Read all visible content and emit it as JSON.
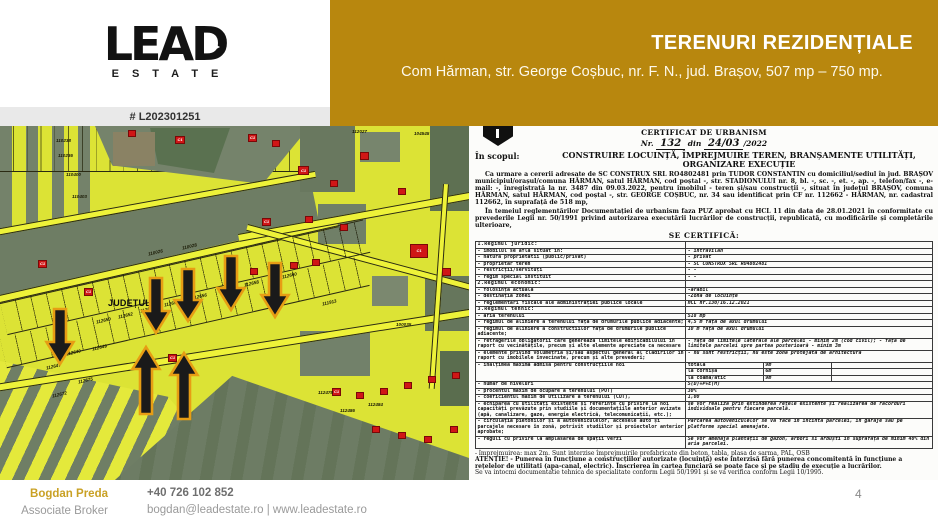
{
  "colors": {
    "band_gold": "#b8870e",
    "brand_gold": "#c9a125",
    "marker_red": "#d01616",
    "arrow_black": "#1a1a1a",
    "arrow_outline": "#e79d14",
    "map_yellow": "#dce335"
  },
  "header": {
    "brand": "LEAD",
    "brand_sub": "ESTATE",
    "ref": "# L202301251",
    "title": "TERENURI REZIDENȚIALE",
    "subtitle": "Com Hărman,  str. George Coșbuc,  nr. F. N.,  jud.  Brașov, 507 mp – 750 mp."
  },
  "map": {
    "region_label": "JUDEȚUL B",
    "building_marker_label": "C1",
    "parcel_labels": [
      "110238",
      "110236",
      "110400",
      "110403",
      "112027",
      "104545",
      "110026",
      "110028",
      "111913",
      "100035",
      "112650",
      "112652",
      "112653",
      "112654",
      "112656",
      "112657",
      "112658",
      "112660",
      "112640",
      "112647",
      "112649",
      "112675",
      "112672",
      "112478",
      "112484",
      "112486"
    ]
  },
  "document": {
    "title": "CERTIFICAT DE URBANISM",
    "nr_prefix": "Nr.",
    "nr_value": "132",
    "din": "din",
    "date_value": "24/03",
    "year": "/2022",
    "scop_label": "În scopul:",
    "scop_line1": "CONSTRUIRE LOCUINȚĂ, ÎMPREJMUIRE TEREN, BRANȘAMENTE UTILITĂȚI,",
    "scop_line2": "ORGANIZARE EXECUȚIE",
    "para1": "Ca urmare a cererii adresate de SC CONSTRUX SRL RO4802481 prin TUDOR CONSTANTIN cu domiciliul/sediul în jud. BRAȘOV municipiul/orașul/comuna HĂRMAN, satul HĂRMAN, cod poștal -, str. STADIONULUI nr. 8, bl. -, sc. -, et. -, ap. -, telefon/fax -, e-mail: -, înregistrată la nr. 3487 din 09.03.2022, pentru imobilul - teren și/sau construcții -, situat în județul BRAȘOV, comuna HĂRMAN, satul HĂRMAN, cod poștal -, str. GEORGE COȘBUC, nr. 34 sau identificat prin CF nr. 112662 - HĂRMAN, nr. cadastral 112662, în suprafață de 518 mp,",
    "para2": "În temeiul reglementărilor Documentației de urbanism faza PUZ aprobat cu HCL 11 din data de 28.01.2021 în conformitate cu prevederile Legii nr. 50/1991 privind autorizarea executării lucrărilor de construcții, republicată, cu modificările și completările ulterioare,",
    "certify": "SE CERTIFICĂ:",
    "table": [
      {
        "type": "sec",
        "l": "1.Regimul juridic:",
        "r": ""
      },
      {
        "l": "- imobilul se află situat în:",
        "r": "- intravilan"
      },
      {
        "l": "- natura proprietatii (public/privat)",
        "r": "- privat"
      },
      {
        "l": "- proprietar teren",
        "r": "- SC CONSTRUX SRL RO4802481"
      },
      {
        "l": "- restricții/servituți",
        "r": "- -"
      },
      {
        "l": "- regim special instituit",
        "r": "- -"
      },
      {
        "type": "sec",
        "l": "2.Regimul economic:",
        "r": ""
      },
      {
        "l": "- folosința actuală",
        "r": "-arabil"
      },
      {
        "l": "- destinația zonei",
        "r": "-Zonă de locuințe"
      },
      {
        "l": "- reglementări fiscale ale administrației publice locale",
        "r": "HCL nr.130/16.12.2021"
      },
      {
        "type": "sec",
        "l": "3.Regimul tehnic:",
        "r": ""
      },
      {
        "l": "- aria terenului",
        "r": "518 mp"
      },
      {
        "l": "- regimul de aliniere a terenului față de drumurile publice adiacente;",
        "r": "4,5 m față de axul drumului"
      },
      {
        "l": "- regimul de aliniere a constructiilor față de drumurile publice adiacente;",
        "r": "10 m față de axul drumului"
      },
      {
        "l": "- retragerile obligatorii care generează limitele edificabilului în raport cu vecinătățile, precum și alte elemente apreciate ca necesare",
        "r": "- față de limitele laterale ale parcelei - minim 2m (cod civil); - față de limitele parcelei spre partea posterioară - minim 3m"
      },
      {
        "l": "- elemente privind volumetria și/sau aspectul general al clădirilor în raport cu imobilele învecinate, precum și alte prevederi;",
        "r": "- nu sunt restricții, nu este zona protejată de arhitectură"
      },
      {
        "type": "multi",
        "l": "- înălțimea maximă admisă pentru construcțiile noi",
        "sub": [
          [
            "totală",
            "9m"
          ],
          [
            "la cornișă",
            "6m"
          ],
          [
            "la coamă/atic",
            "9m"
          ]
        ]
      },
      {
        "l": "- număr de niveluri",
        "r": "S(D)+P+E(M)"
      },
      {
        "l": "- procentul maxim de ocupare a terenului (POT)",
        "r": "30%"
      },
      {
        "l": "- coeficientul maxim de utilizare a terenului (CUT),",
        "r": "1,00"
      },
      {
        "l": "- echiparea cu utilități existente și referințe cu privire la noi capacități prevăzute prin studiile și documentațiile anterior avizate (apă, canalizare, gaze, energie electrică, telecomunicații, etc.);",
        "r": "se vor realiza prin extinderea rețele existente și realizarea de racorduri individuale pentru fiecare parcelă."
      },
      {
        "l": "- circulația pietonilor și a autovehiculelor, accesele auto și parcajele necesare în zonă, potrivit studiilor și proiectelor anterior aprobate;",
        "r": "Parcarea autovehiculelor se va face în incinta parcelei, în garaje sau pe platforme special amenajate."
      },
      {
        "l": "- reguli cu privire la amplasarea de spații verzi",
        "r": "Se vor amenaja plantații de gazon, arbori si arbuști în suprafață de minim 40% din aria parcelei."
      }
    ],
    "footnote1": "- împrejmuirea: max 2m. Sunt interzise împrejmuirile prefabricate din beton, tabla, plasa de sarma, PAL, OSB",
    "footnote2": "ATENȚIE! - Punerea în funcțiune a construcțiilor autorizate (locuință) este interzisă fără punerea concomitentă în funcțiune a rețelelor de utilitati (apa-canal, electric). Înscrierea în cartea funciară se poate face și pe stadiu de execuție a lucrărilor.",
    "footnote3": "Se va intocmi documentatie tehnica de specialitate conform Legii 50/1991 și se va verifica conform Legii 10/1995."
  },
  "footer": {
    "name": "Bogdan Preda",
    "role": "Associate Broker",
    "phone": "+40 726 102 852",
    "email_line": "bogdan@leadestate.ro | www.leadestate.ro",
    "page": "4"
  }
}
